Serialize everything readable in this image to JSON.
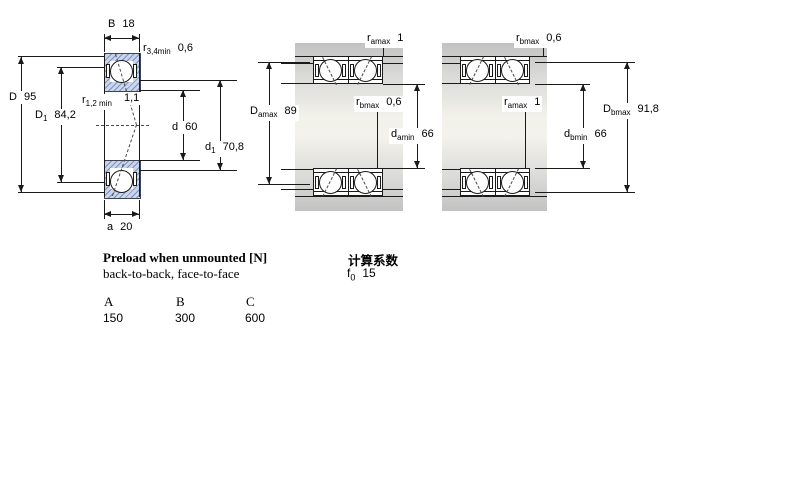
{
  "figures": {
    "bearing_cross_section": {
      "dims": {
        "B": {
          "text": "B",
          "value": "18"
        },
        "r34": {
          "base": "r",
          "sub": "3,4min",
          "value": "0,6"
        },
        "D": {
          "text": "D",
          "value": "95"
        },
        "D1": {
          "base": "D",
          "sub": "1",
          "value": "84,2"
        },
        "r12": {
          "base": "r",
          "sub": "1,2 min",
          "value": "1,1"
        },
        "d": {
          "text": "d",
          "value": "60"
        },
        "d1": {
          "base": "d",
          "sub": "1",
          "value": "70,8"
        },
        "a": {
          "text": "a",
          "value": "20"
        }
      }
    },
    "arrangement_a": {
      "dims": {
        "ramax": {
          "base": "r",
          "sub": "amax",
          "value": "1"
        },
        "Damax": {
          "base": "D",
          "sub": "amax",
          "value": "89"
        },
        "rbmax": {
          "base": "r",
          "sub": "bmax",
          "value": "0,6"
        },
        "damin": {
          "base": "d",
          "sub": "amin",
          "value": "66"
        }
      }
    },
    "arrangement_b": {
      "dims": {
        "rbmax": {
          "base": "r",
          "sub": "bmax",
          "value": "0,6"
        },
        "ramax": {
          "base": "r",
          "sub": "amax",
          "value": "1"
        },
        "Dbmax": {
          "base": "D",
          "sub": "bmax",
          "value": "91,8"
        },
        "dbmin": {
          "base": "d",
          "sub": "bmin",
          "value": "66"
        }
      }
    }
  },
  "preload": {
    "title": "Preload when unmounted [N]",
    "subtitle": "back-to-back, face-to-face",
    "columns": [
      "A",
      "B",
      "C"
    ],
    "values": [
      "150",
      "300",
      "600"
    ]
  },
  "calculation": {
    "title": "计算系数",
    "f0_base": "f",
    "f0_sub": "0",
    "f0_value": "15"
  },
  "colors": {
    "line": "#1a1a1a",
    "hatch_fill": "#c9d6ee",
    "hatch_line": "#7e90b8",
    "housing_gray": "#c2c2c2"
  }
}
